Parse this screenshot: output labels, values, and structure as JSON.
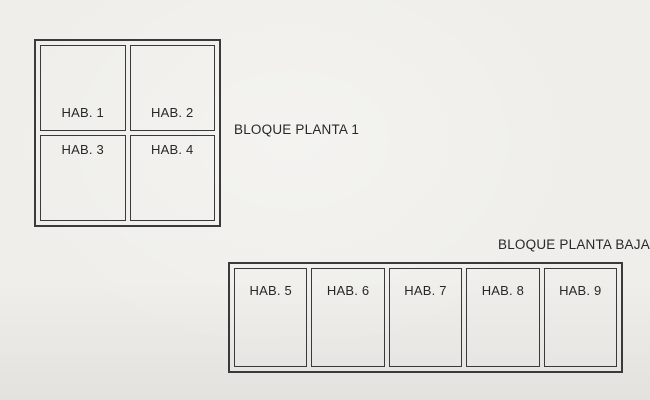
{
  "canvas": {
    "background": "#efeeea",
    "line_color": "#3a3a3a",
    "text_color": "#282828"
  },
  "planta1": {
    "title": "BLOQUE PLANTA 1",
    "rooms": [
      "HAB. 1",
      "HAB. 2",
      "HAB. 3",
      "HAB. 4"
    ]
  },
  "planta_baja": {
    "title": "BLOQUE PLANTA BAJA",
    "rooms": [
      "HAB. 5",
      "HAB. 6",
      "HAB. 7",
      "HAB. 8",
      "HAB. 9"
    ]
  }
}
